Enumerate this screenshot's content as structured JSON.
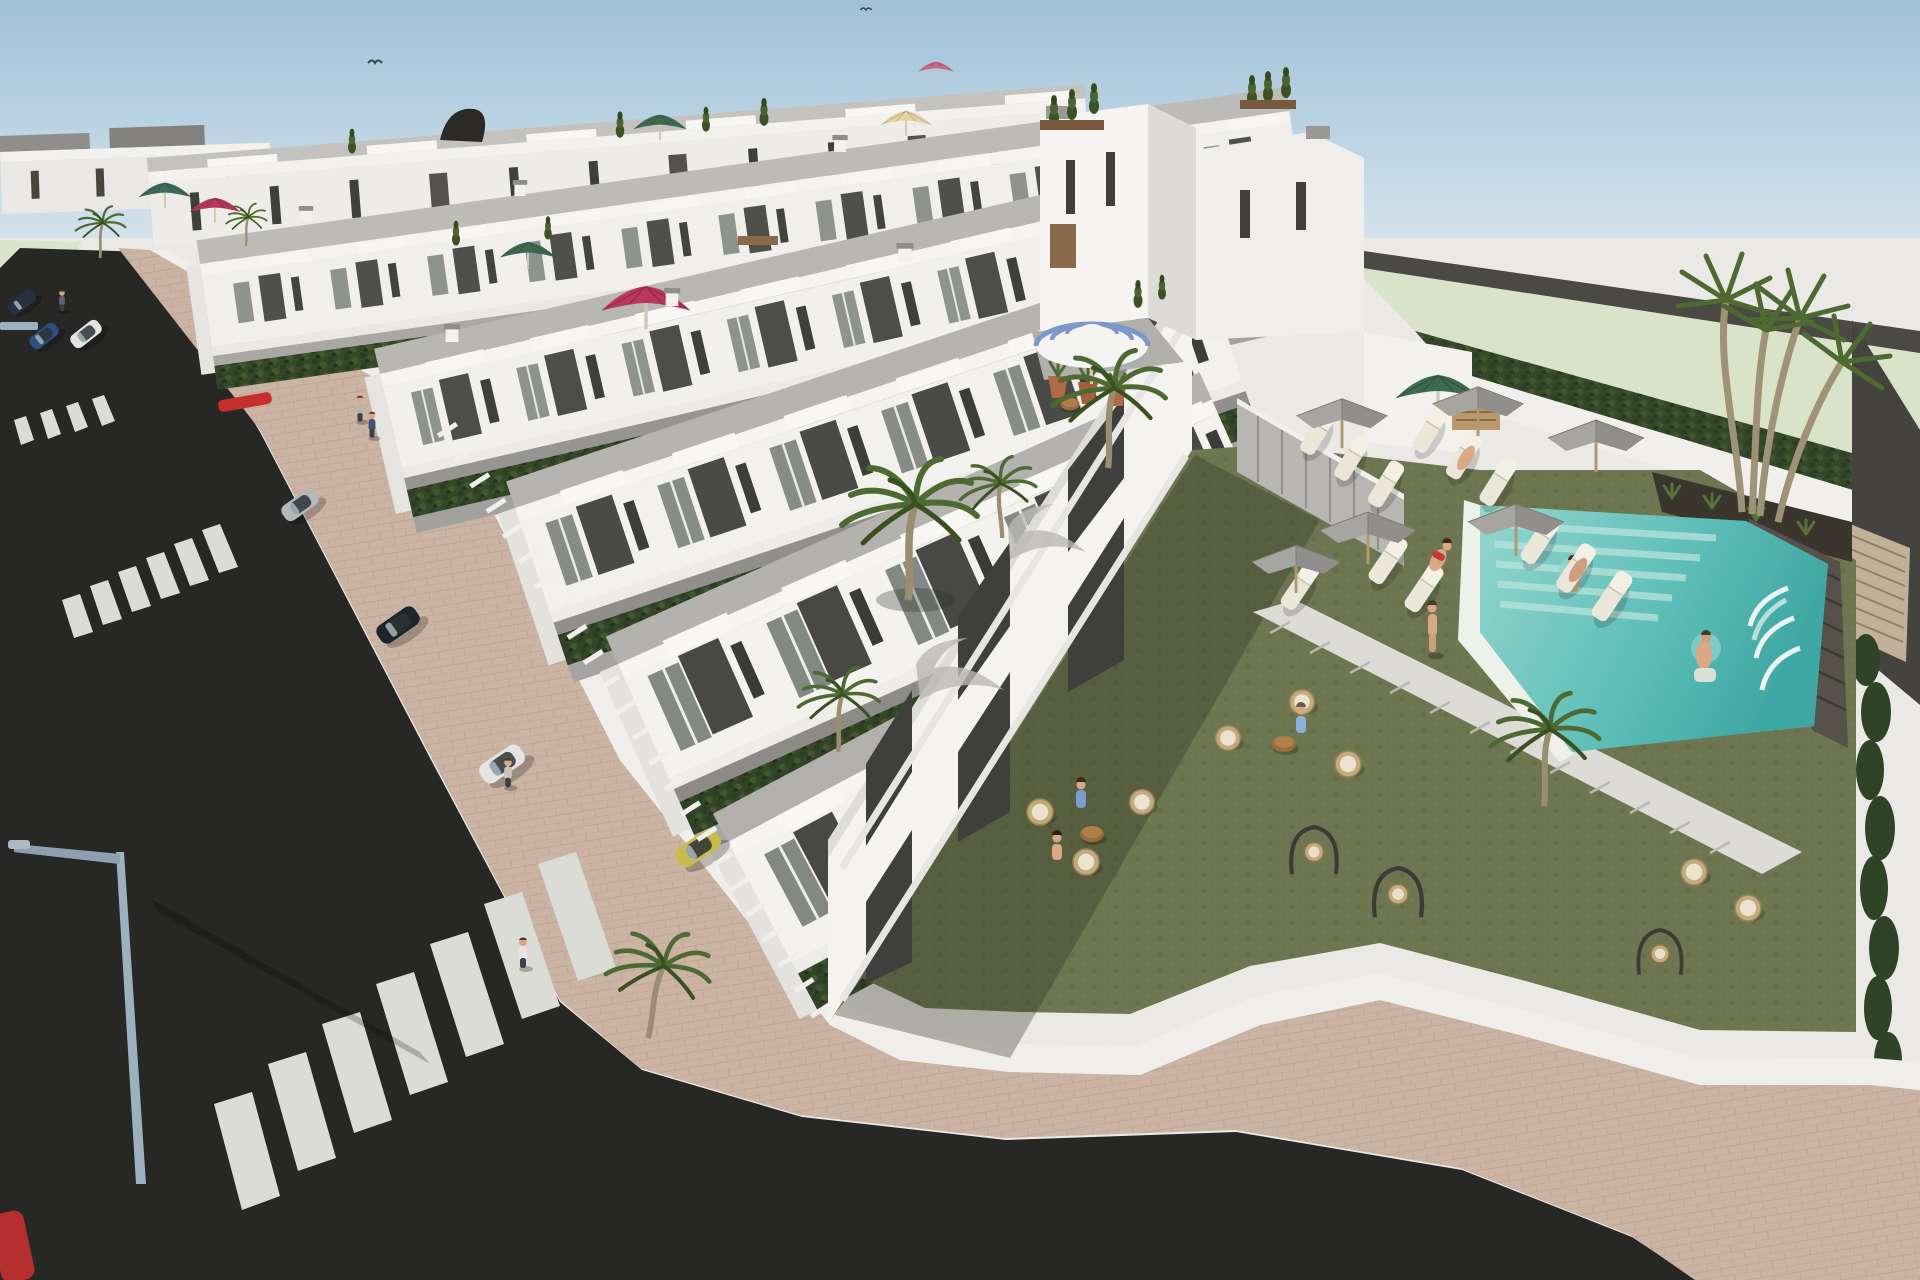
{
  "meta": {
    "title": "3D architectural rendering of a coastal residential development with terraced townhouses, street and communal pool garden",
    "render_type": "exterior aerial perspective",
    "visible_text": "none"
  },
  "palette": {
    "sky_top": "#9fc2d8",
    "sky_bottom": "#d3e2ec",
    "horizon_haze": "#eae9e5",
    "far_field_green": "#d8e3c9",
    "boundary_wall_dark": "#4a4944",
    "right_wall_dark": "#44433e",
    "louver_tan": "#c2b199",
    "building_white": "#f3f2ef",
    "building_shaded": "#dddcd8",
    "terrace_grey": "#b9b8b4",
    "accent_panel_dark": "#4d4d4a",
    "glass_grey": "#8d948f",
    "window_dark": "#3f3f3d",
    "hedge_green": "#35482b",
    "lawn_green": "#6d7650",
    "palm_green": "#4d6a33",
    "trunk_brown": "#9b8d6f",
    "pool_water": "#62c0ba",
    "pool_steps": "#b9e3dc",
    "pool_stone_wall": "#565149",
    "asphalt": "#272725",
    "sidewalk_paver": "#ccb4a4",
    "curb_white": "#efeeea",
    "crosswalk_white": "#dcdcd7",
    "parasol_grey": "#a3a29e",
    "umbrella_crimson": "#b8365f",
    "umbrella_green": "#3e6a50",
    "umbrella_teal": "#3f6a5e",
    "umbrella_cream": "#e4d3a4",
    "umbrella_pink": "#c96a86",
    "umbrella_stripe_blue": "#7d98c9",
    "wicker_tan": "#c3aa80",
    "cushion_cream": "#ebe3d0",
    "wood_table": "#9a6b3c",
    "car_silver": "#b3b8ba",
    "car_navy": "#233247",
    "car_blue": "#2e4e7e",
    "car_white": "#e4e5e2",
    "car_yellow": "#c9ba4e",
    "car_red": "#b62f2f",
    "skin_tone": "#d9a884"
  },
  "scene": {
    "labels": {
      "render": "aerial 3D render of white terraced townhouse development",
      "sky": "clear sky with two distant birds",
      "far_field": "pale green field beyond perimeter wall",
      "buildings": "rows of white two–three storey townhouses with roof terraces, balconies and dark accent panels",
      "roof_terraces": "roof terraces with parasols, potted plants and furniture",
      "street": "asphalt street with three zebra crossings",
      "sidewalk": "pink paved sidewalk with streetlight and pedestrians",
      "parked_cars": "cars parked along street and in hedged driveways",
      "pool_area": "communal turquoise pool with swimmers, waterfall wall and palm cluster",
      "sun_terrace": "sun loungers with grey parasols on lawn",
      "lounge_garden": "wicker lounge chairs, round tables and swing seats on lawn",
      "boundary": "curved perimeter hedge on white wall with paver walk"
    },
    "counts": {
      "townhouse_rows": 6,
      "zebra_crossings": 3,
      "roof_umbrellas": 8,
      "grey_parasols": 6,
      "sun_loungers": 12,
      "wicker_chairs": 8,
      "swing_seats": 3,
      "palm_trees": 9,
      "swimmers": 2,
      "pedestrians": 5,
      "cars": 9,
      "birds": 2
    }
  }
}
